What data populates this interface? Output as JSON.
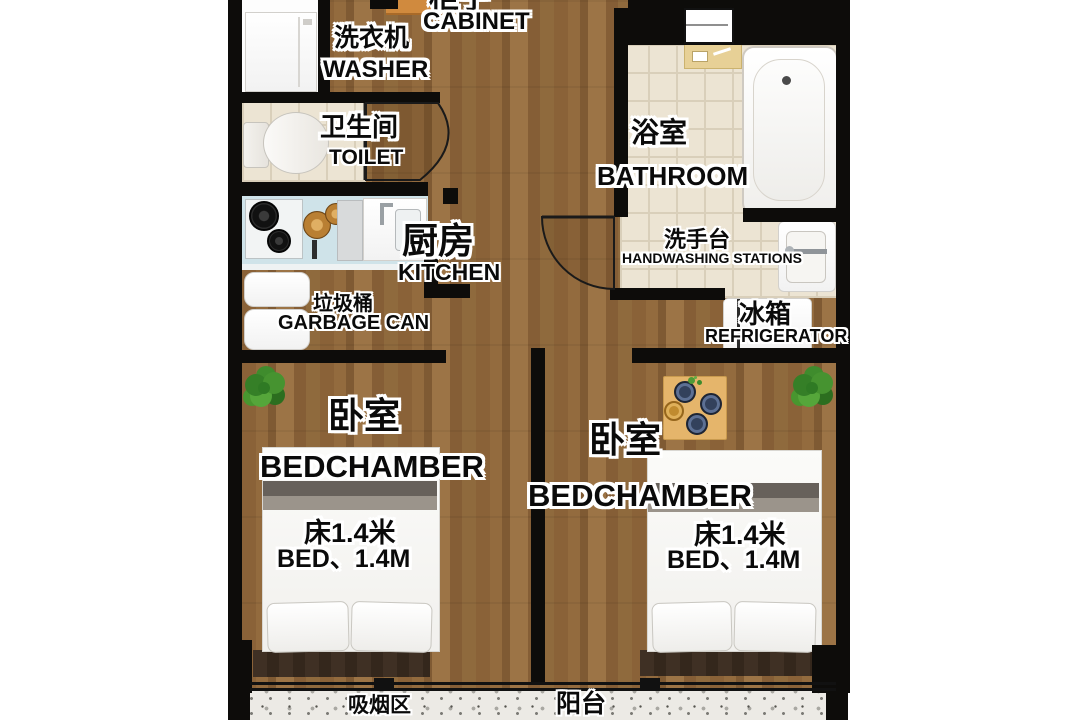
{
  "title": "two-bedroom apartment floor plan",
  "palette": {
    "wall": "#0d0c0a",
    "wood_floor": "#8a6238",
    "tile_floor": "#ece4d3",
    "terrazzo_floor": "#eceae5",
    "counter": "#cfe3e9",
    "cabinet": "#d08a3e",
    "label_text": "#0a0a0a",
    "label_outline": "#ffffff"
  },
  "rooms": {
    "cabinet": {
      "zh": "柜子",
      "en": "CABINET"
    },
    "washer": {
      "zh": "洗衣机",
      "en": "WASHER"
    },
    "toilet": {
      "zh": "卫生间",
      "en": "TOILET"
    },
    "bathroom": {
      "zh": "浴室",
      "en": "BATHROOM"
    },
    "kitchen": {
      "zh": "厨房",
      "en": "KITCHEN"
    },
    "handwashing": {
      "zh": "洗手台",
      "en": "HANDWASHING STATIONS"
    },
    "garbage": {
      "zh": "垃圾桶",
      "en": "GARBAGE CAN"
    },
    "refrigerator": {
      "zh": "冰箱",
      "en": "REFRIGERATOR"
    },
    "bedroom_left": {
      "zh": "卧室",
      "en": "BEDCHAMBER",
      "bed_zh": "床1.4米",
      "bed_en": "BED、1.4M"
    },
    "bedroom_right": {
      "zh": "卧室",
      "en": "BEDCHAMBER",
      "bed_zh": "床1.4米",
      "bed_en": "BED、1.4M"
    },
    "smoking_area": {
      "zh": "吸烟区"
    },
    "balcony": {
      "zh": "阳台"
    }
  }
}
